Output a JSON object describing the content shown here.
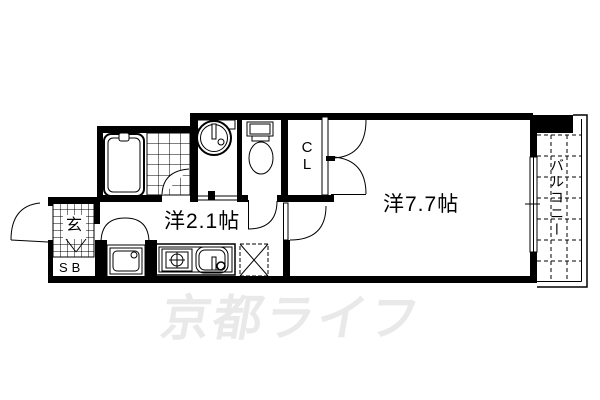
{
  "plan_title": "1K apartment floor plan",
  "colors": {
    "background": "#ffffff",
    "line": "#000000",
    "watermark": "#e9e9e9"
  },
  "watermark": {
    "text": "京都ライフ"
  },
  "rooms": {
    "main_room": {
      "label": "洋7.7帖"
    },
    "kitchen_hall": {
      "label": "洋2.1帖"
    },
    "closet": {
      "label": "CL",
      "label_chars": [
        "C",
        "L"
      ]
    },
    "balcony": {
      "label": "バルコニー"
    },
    "entrance": {
      "label": "玄"
    },
    "shoe_box": {
      "label": "SB"
    }
  },
  "icons": [
    "bathtub-icon",
    "bath-tile-floor-icon",
    "washbasin-icon",
    "toilet-icon",
    "washing-machine-space-icon",
    "gas-stove-icon",
    "kitchen-sink-icon",
    "refrigerator-space-icon",
    "entrance-step-icon",
    "door-swing-icon",
    "double-door-icon",
    "window-icon",
    "balcony-tile-icon"
  ]
}
